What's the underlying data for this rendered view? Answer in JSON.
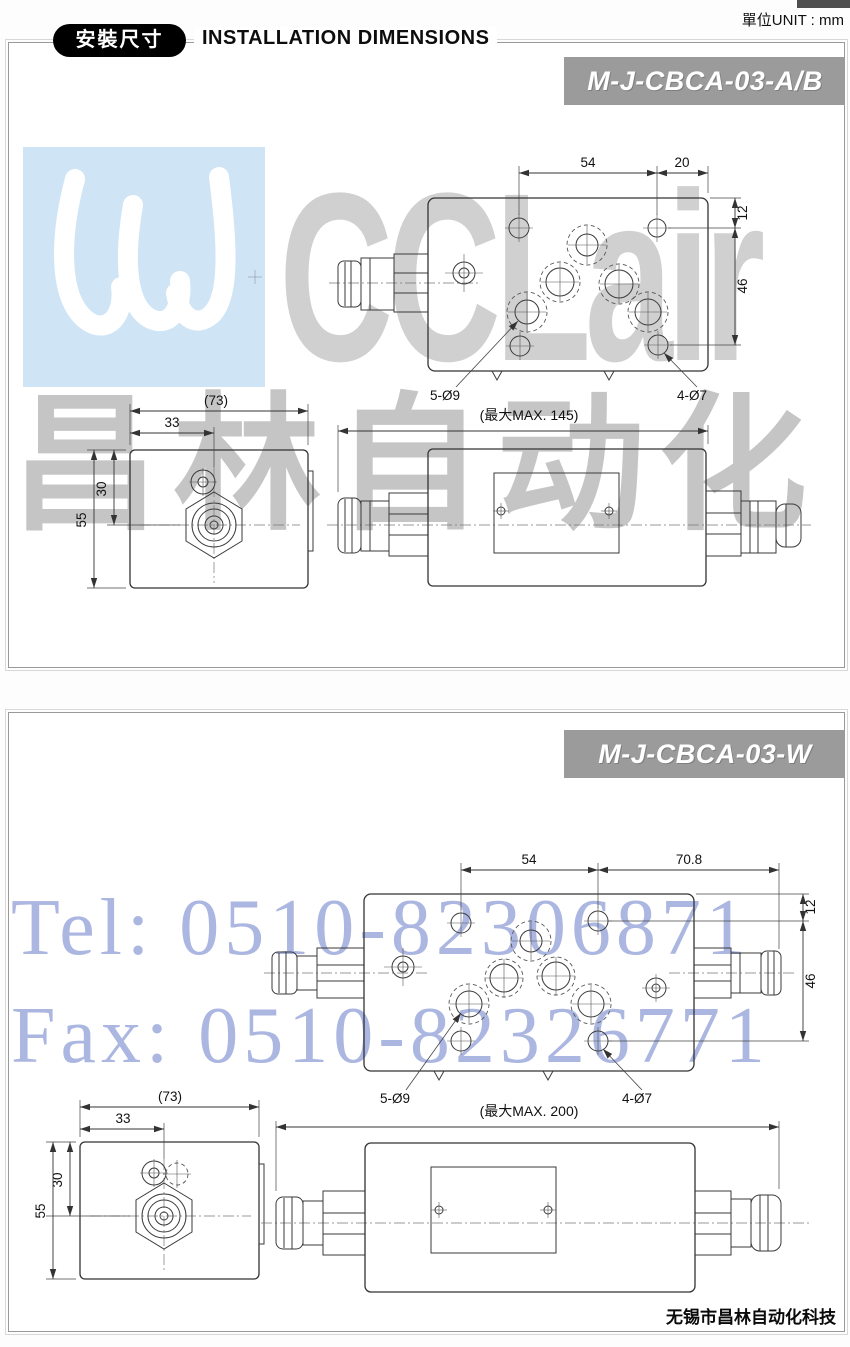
{
  "page": {
    "unit_label": "單位UNIT : mm",
    "header_badge": "安裝尺寸",
    "header_title": "INSTALLATION DIMENSIONS",
    "footer_company": "无锡市昌林自动化科技"
  },
  "watermark": {
    "logo_text": "CCLair",
    "cn_text": "昌林自动化",
    "tel_text": "Tel: 0510-82306871",
    "fax_text": "Fax: 0510-82326771",
    "logo_bg_color": "#cfe4f5",
    "logo_text_color": "#c8c8c8",
    "telfax_color": "#a7b3e0"
  },
  "panel1": {
    "model_badge": "M-J-CBCA-03-A/B",
    "top": {
      "d54": "54",
      "d20": "20",
      "d12": "12",
      "d46": "46",
      "holes9": "5-Ø9",
      "holes7": "4-Ø7"
    },
    "side": {
      "d73": "(73)",
      "d33": "33",
      "d30": "30",
      "d55": "55"
    },
    "front": {
      "dmax": "(最大MAX. 145)"
    }
  },
  "panel2": {
    "model_badge": "M-J-CBCA-03-W",
    "top": {
      "d54": "54",
      "d708": "70.8",
      "d12": "12",
      "d46": "46",
      "holes9": "5-Ø9",
      "holes7": "4-Ø7"
    },
    "side": {
      "d73": "(73)",
      "d33": "33",
      "d30": "30",
      "d55": "55"
    },
    "front": {
      "dmax": "(最大MAX. 200)"
    }
  }
}
